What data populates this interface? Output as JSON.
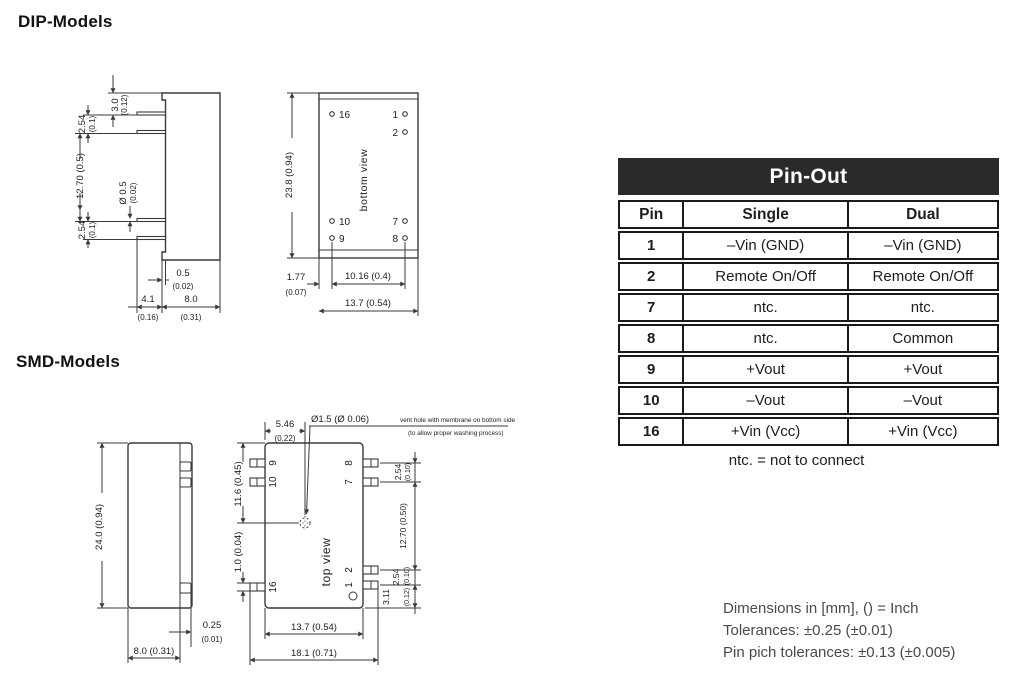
{
  "headings": {
    "dip": "DIP-Models",
    "smd": "SMD-Models"
  },
  "pinout": {
    "title": "Pin-Out",
    "columns": {
      "pin": "Pin",
      "single": "Single",
      "dual": "Dual"
    },
    "rows": [
      {
        "pin": "1",
        "single": "–Vin (GND)",
        "dual": "–Vin (GND)"
      },
      {
        "pin": "2",
        "single": "Remote On/Off",
        "dual": "Remote On/Off"
      },
      {
        "pin": "7",
        "single": "ntc.",
        "dual": "ntc."
      },
      {
        "pin": "8",
        "single": "ntc.",
        "dual": "Common"
      },
      {
        "pin": "9",
        "single": "+Vout",
        "dual": "+Vout"
      },
      {
        "pin": "10",
        "single": "–Vout",
        "dual": "–Vout"
      },
      {
        "pin": "16",
        "single": "+Vin (Vcc)",
        "dual": "+Vin (Vcc)"
      }
    ],
    "footnote": "ntc. = not to connect",
    "header_bg": "#2b2a29",
    "header_text": "#ffffff"
  },
  "dip_side": {
    "dims": {
      "d3_mm": "3.0",
      "d3_in": "(0.12)",
      "d254t_mm": "2.54",
      "d254t_in": "(0.1)",
      "d1270": "12.70 (0.5)",
      "dia_mm": "Ø 0.5",
      "dia_in": "(0.02)",
      "d254b_mm": "2.54",
      "d254b_in": "(0.1)",
      "d05_mm": "0.5",
      "d05_in": "(0.02)",
      "d41_mm": "4.1",
      "d41_in": "(0.16)",
      "d80_mm": "8.0",
      "d80_in": "(0.31)"
    }
  },
  "dip_bottom": {
    "view_label": "bottom view",
    "pins": {
      "p16": "16",
      "p1": "1",
      "p2": "2",
      "p10": "10",
      "p9": "9",
      "p7": "7",
      "p8": "8"
    },
    "dims": {
      "h": "23.8 (0.94)",
      "d177_mm": "1.77",
      "d177_in": "(0.07)",
      "d1016": "10.16 (0.4)",
      "d137": "13.7 (0.54)"
    }
  },
  "smd_side": {
    "dims": {
      "h": "24.0 (0.94)",
      "d025_mm": "0.25",
      "d025_in": "(0.01)",
      "w": "8.0 (0.31)"
    }
  },
  "smd_top": {
    "view_label": "top view",
    "pins": {
      "p9": "9",
      "p10": "10",
      "p16": "16",
      "p8": "8",
      "p7": "7",
      "p2": "2",
      "p1": "1"
    },
    "vent": {
      "dia": "Ø1.5 (Ø 0.06)",
      "note1": "vent hole with membrane on bottom side",
      "note2": "(to allow proper washing process)"
    },
    "dims": {
      "d546_mm": "5.46",
      "d546_in": "(0.22)",
      "d116": "11.6 (0.45)",
      "d10": "1.0 (0.04)",
      "d254t_mm": "2.54",
      "d254t_in": "(0.10)",
      "d1270": "12.70 (0.50)",
      "d254b_mm": "2.54",
      "d254b_in": "(0.10)",
      "d311_mm": "3.11",
      "d311_in": "(0.12)",
      "d137": "13.7 (0.54)",
      "d181": "18.1 (0.71)"
    }
  },
  "notes": {
    "line1": "Dimensions in [mm], () = Inch",
    "line2": "Tolerances: ±0.25 (±0.01)",
    "line3": "Pin pich tolerances: ±0.13 (±0.005)"
  }
}
